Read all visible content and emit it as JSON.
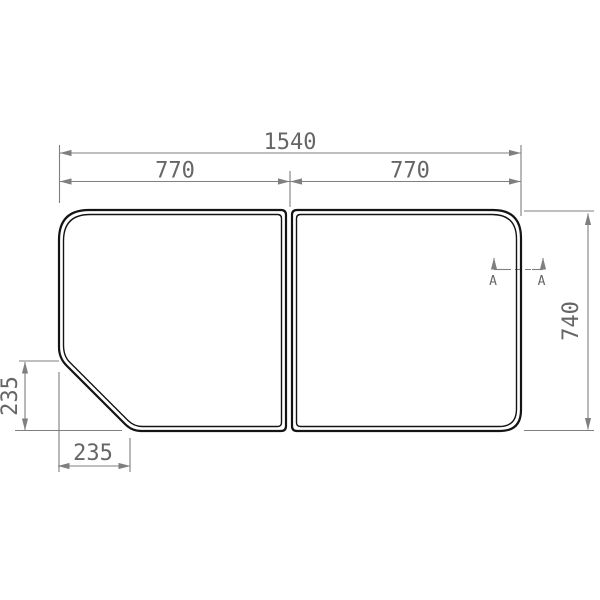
{
  "colors": {
    "background": "#ffffff",
    "dimension_line": "#7f7f7f",
    "dimension_text": "#666666",
    "panel_outline": "#141414"
  },
  "dimensions": {
    "overall_width": "1540",
    "left_panel_width": "770",
    "right_panel_width": "770",
    "overall_height": "740",
    "corner_cut_height": "235",
    "corner_cut_width": "235"
  },
  "section_marker": {
    "left_label": "A",
    "right_label": "A"
  }
}
